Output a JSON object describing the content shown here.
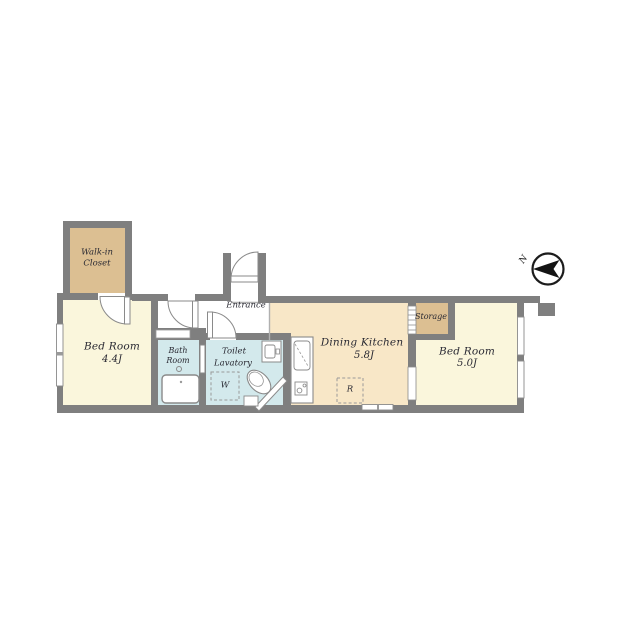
{
  "title": "1DK apartment floor plan",
  "colors": {
    "wall": "#7f7f7f",
    "line": "#8a8a8a",
    "room_cream": "#faf6dc",
    "room_peach": "#f8e7c7",
    "room_tan": "#dcbf92",
    "room_blue": "#d3e9ec",
    "ink": "#141414"
  },
  "rooms": {
    "walk_in_closet": {
      "name": "Walk-in Closet"
    },
    "bedroom1": {
      "name": "Bed Room",
      "area": "4.4J"
    },
    "bathroom": {
      "name": "Bath Room"
    },
    "toilet_lavatory": {
      "line1": "Toilet",
      "line2": "Lavatory"
    },
    "entrance": {
      "name": "Entrance"
    },
    "dining_kitchen": {
      "name": "Dining Kitchen",
      "area": "5.8J"
    },
    "storage": {
      "name": "Storage"
    },
    "bedroom2": {
      "name": "Bed Room",
      "area": "5.0J"
    }
  },
  "fixtures": {
    "washer_label": "W",
    "refrigerator_label": "R"
  },
  "compass": {
    "north_label": "N"
  }
}
